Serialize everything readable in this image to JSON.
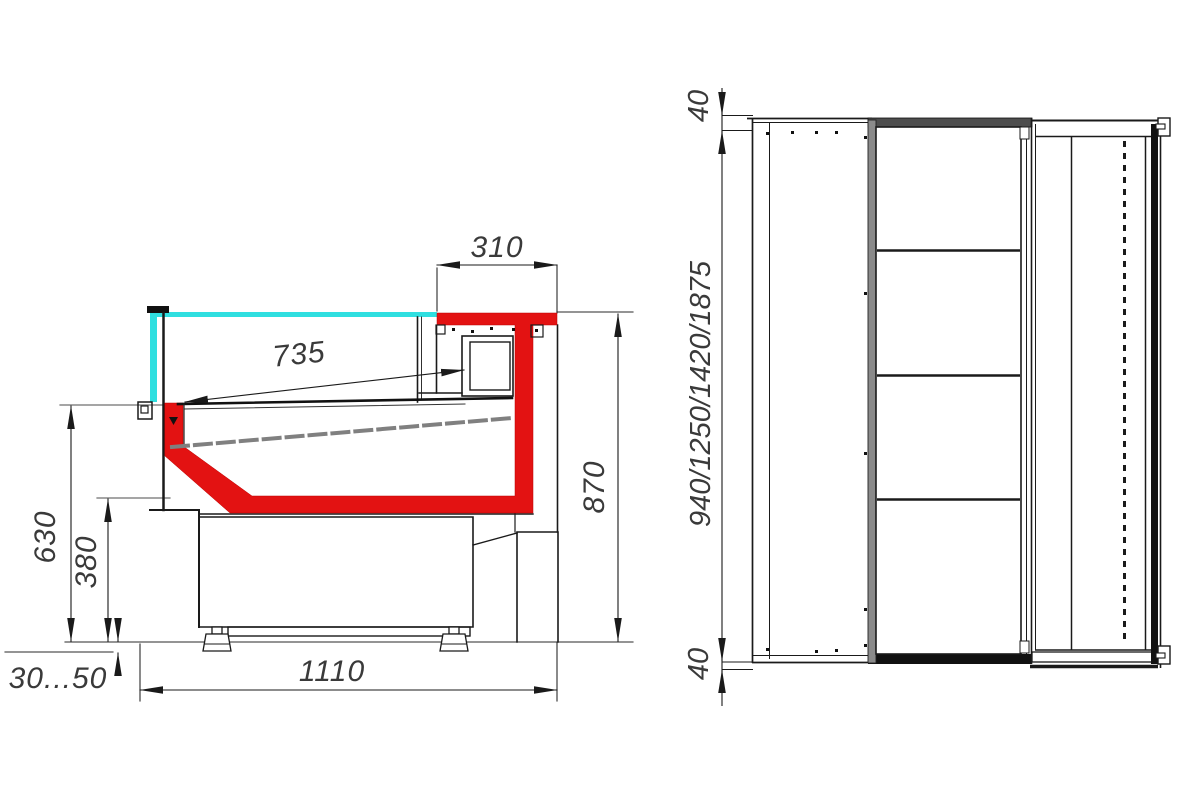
{
  "drawing": {
    "title": "display-case-technical-drawing",
    "side_view": {
      "dim_top_depth": "310",
      "dim_display_depth": "735",
      "dim_overall_height": "870",
      "dim_front_height": "630",
      "dim_base_height": "380",
      "dim_foot_adjust": "30...50",
      "dim_total_depth": "1110"
    },
    "plan_view": {
      "dim_end_top": "40",
      "dim_lengths": "940/1250/1420/1875",
      "dim_end_bottom": "40"
    },
    "colors": {
      "profile_red": "#e31212",
      "glass_cyan": "#2fdfe0",
      "line_dark": "#1a1a1a"
    }
  }
}
